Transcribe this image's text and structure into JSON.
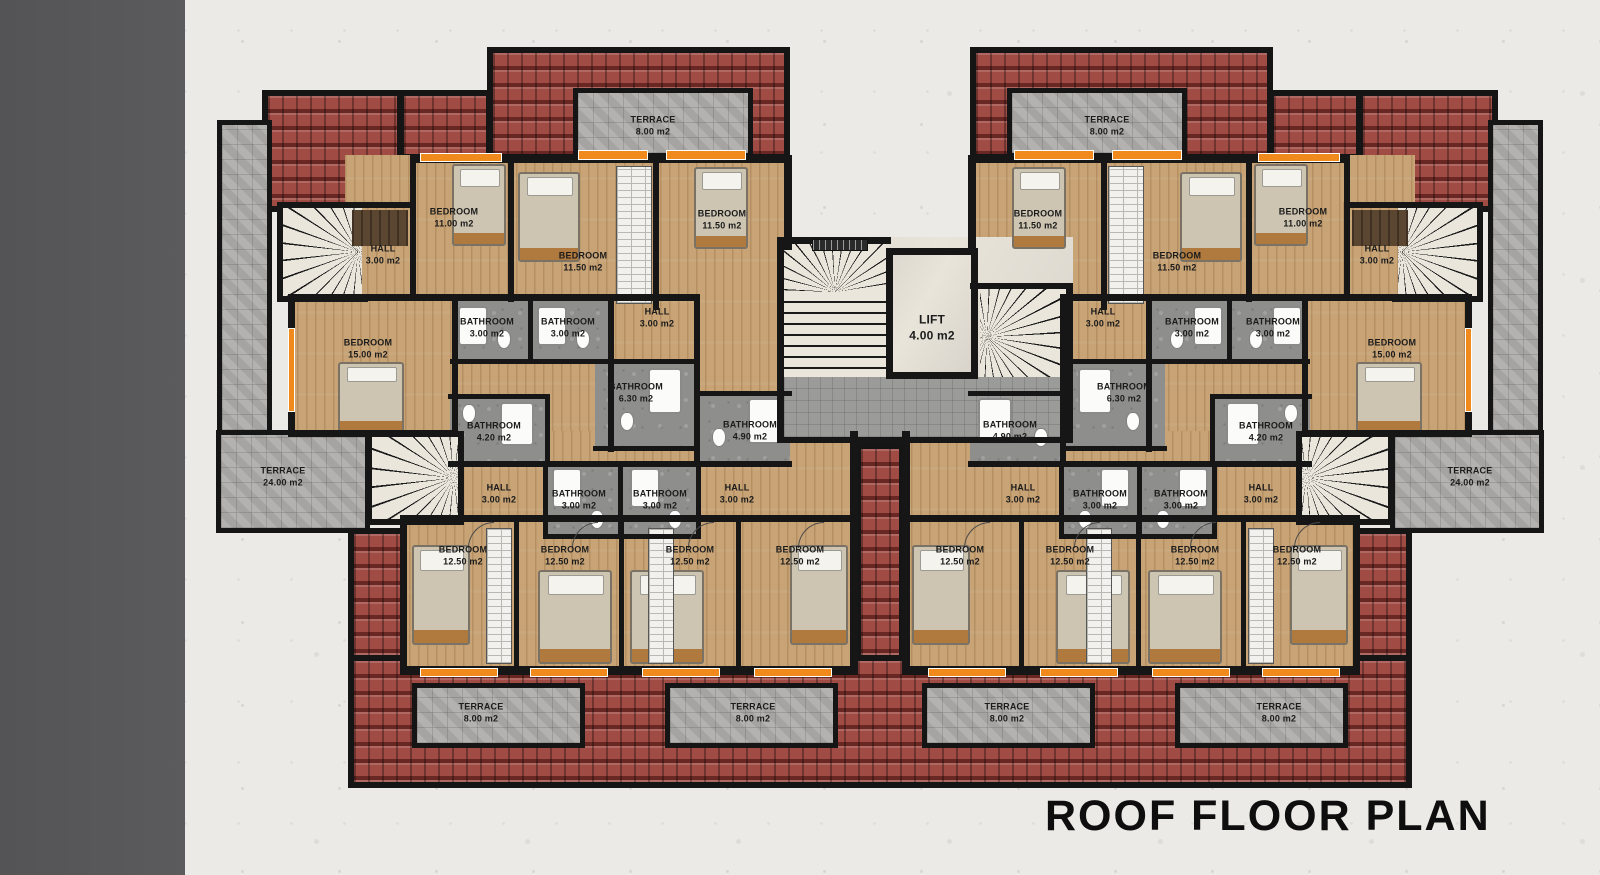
{
  "title": "ROOF FLOOR PLAN",
  "room_types": {
    "terrace8": {
      "name": "TERRACE",
      "area": "8.00 m2"
    },
    "terrace24": {
      "name": "TERRACE",
      "area": "24.00 m2"
    },
    "bedroom11": {
      "name": "BEDROOM",
      "area": "11.00 m2"
    },
    "bedroom115": {
      "name": "BEDROOM",
      "area": "11.50 m2"
    },
    "bedroom125": {
      "name": "BEDROOM",
      "area": "12.50 m2"
    },
    "bedroom15": {
      "name": "BEDROOM",
      "area": "15.00 m2"
    },
    "hall3": {
      "name": "HALL",
      "area": "3.00 m2"
    },
    "bath3": {
      "name": "BATHROOM",
      "area": "3.00 m2"
    },
    "bath42": {
      "name": "BATHROOM",
      "area": "4.20 m2"
    },
    "bath49": {
      "name": "BATHROOM",
      "area": "4.90 m2"
    },
    "bath63": {
      "name": "BATHROOM",
      "area": "6.30 m2"
    },
    "lift4": {
      "name": "LIFT",
      "area": "4.00 m2"
    }
  },
  "colors": {
    "roof_red": "#a04b44",
    "wall_black": "#161616",
    "wood_floor": "#c7a376",
    "terrace_tile": "#aeadab",
    "bathroom_gray": "#8e8f8d",
    "accent_orange": "#f08a1d",
    "background": "#eceae6",
    "side_strip": "#59595b"
  }
}
